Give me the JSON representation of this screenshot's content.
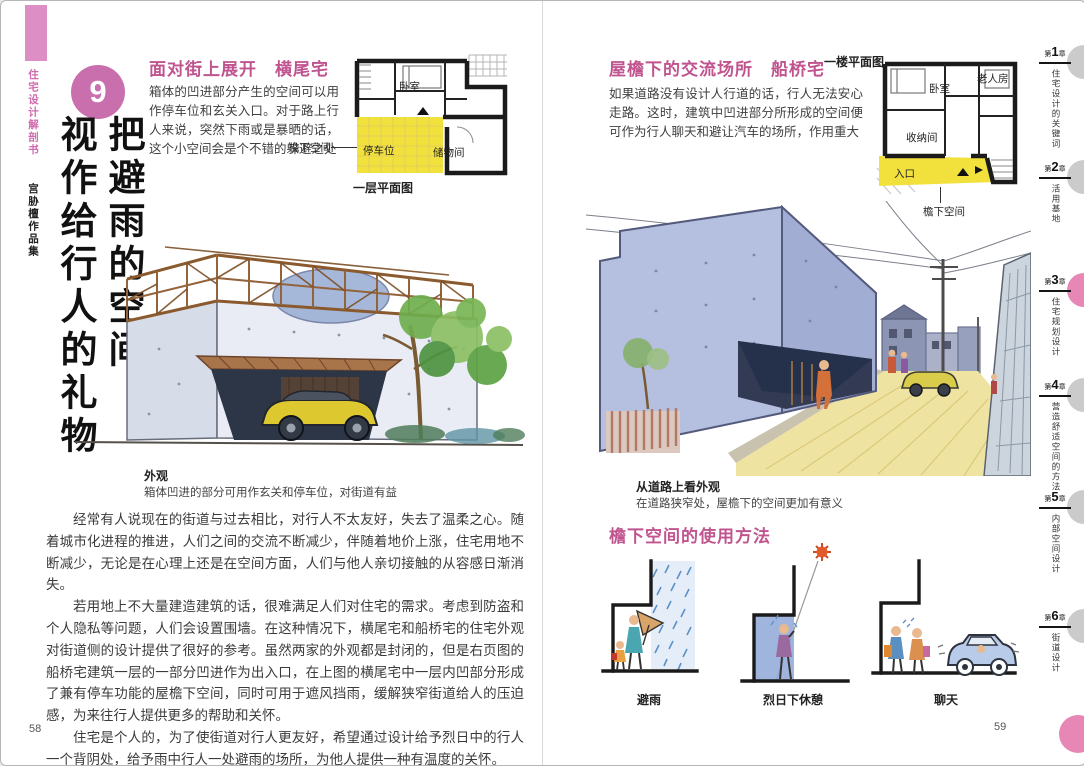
{
  "book": {
    "series_title": "住宅设计解剖书",
    "series_subtitle": "宫胁檀作品集"
  },
  "left_page": {
    "chapter_number": "9",
    "chapter_title_line1": "把避雨的空间",
    "chapter_title_line2": "视作给行人的礼物",
    "section_heading": "面对街上展开　横尾宅",
    "section_intro": "箱体的凹进部分产生的空间可以用作停车位和玄关入口。对于路上行人来说，突然下雨或是暴晒的话，这个小空间会是个不错的躲避之处",
    "floor_plan": {
      "labels": {
        "bedroom": "卧室",
        "parking": "停车位",
        "storage": "储物间",
        "eave_space": "檐下空间"
      },
      "caption": "一层平面图"
    },
    "illustration_caption": {
      "title": "外观",
      "text": "箱体凹进的部分可用作玄关和停车位，对街道有益"
    },
    "paragraphs": [
      "经常有人说现在的街道与过去相比，对行人不太友好，失去了温柔之心。随着城市化进程的推进，人们之间的交流不断减少，伴随着地价上涨，住宅用地不断减少，无论是在心理上还是在空间方面，人们与他人亲切接触的从容感日渐消失。",
      "若用地上不大量建造建筑的话，很难满足人们对住宅的需求。考虑到防盗和个人隐私等问题，人们会设置围墙。在这种情况下，横尾宅和船桥宅的住宅外观对街道侧的设计提供了很好的参考。虽然两家的外观都是封闭的，但是右页图的船桥宅建筑一层的一部分凹进作为出入口，在上图的横尾宅中一层内凹部分形成了兼有停车功能的屋檐下空间，同时可用于遮风挡雨，缓解狭窄街道给人的压迫感，为来往行人提供更多的帮助和关怀。",
      "住宅是个人的，为了使街道对行人更友好，希望通过设计给予烈日中的行人一个背阴处，给予雨中行人一处避雨的场所，为他人提供一种有温度的关怀。"
    ],
    "page_number": "58"
  },
  "right_page": {
    "section_heading": "屋檐下的交流场所　船桥宅",
    "section_intro": "如果道路没有设计人行道的话，行人无法安心走路。这时，建筑中凹进部分所形成的空间便可作为行人聊天和避让汽车的场所，作用重大",
    "floor_plan": {
      "caption": "一楼平面图",
      "labels": {
        "bedroom": "卧室",
        "elder_room": "老人房",
        "storage": "收纳间",
        "entrance": "入口",
        "eave_space": "檐下空间"
      }
    },
    "illustration_caption": {
      "title": "从道路上看外观",
      "text": "在道路狭窄处，屋檐下的空间更加有意义"
    },
    "usage_heading": "檐下空间的使用方法",
    "usage_items": [
      {
        "caption": "避雨"
      },
      {
        "caption": "烈日下休憩"
      },
      {
        "caption": "聊天"
      }
    ],
    "page_number": "59"
  },
  "sidebar_tabs": [
    {
      "prefix": "第",
      "num": "1",
      "suffix": "章",
      "label": "住宅设计的关键词",
      "active": false
    },
    {
      "prefix": "第",
      "num": "2",
      "suffix": "章",
      "label": "活用基地",
      "active": false
    },
    {
      "prefix": "第",
      "num": "3",
      "suffix": "章",
      "label": "住宅规划设计",
      "active": true
    },
    {
      "prefix": "第",
      "num": "4",
      "suffix": "章",
      "label": "营造舒适空间的方法",
      "active": false
    },
    {
      "prefix": "第",
      "num": "5",
      "suffix": "章",
      "label": "内部空间设计",
      "active": false
    },
    {
      "prefix": "第",
      "num": "6",
      "suffix": "章",
      "label": "街道设计",
      "active": false
    }
  ],
  "colors": {
    "accent_pink": "#c0548f",
    "tab_active_pink": "#e687b6",
    "tab_grey": "#cbcbcb",
    "plan_yellow": "#f2e13c"
  }
}
